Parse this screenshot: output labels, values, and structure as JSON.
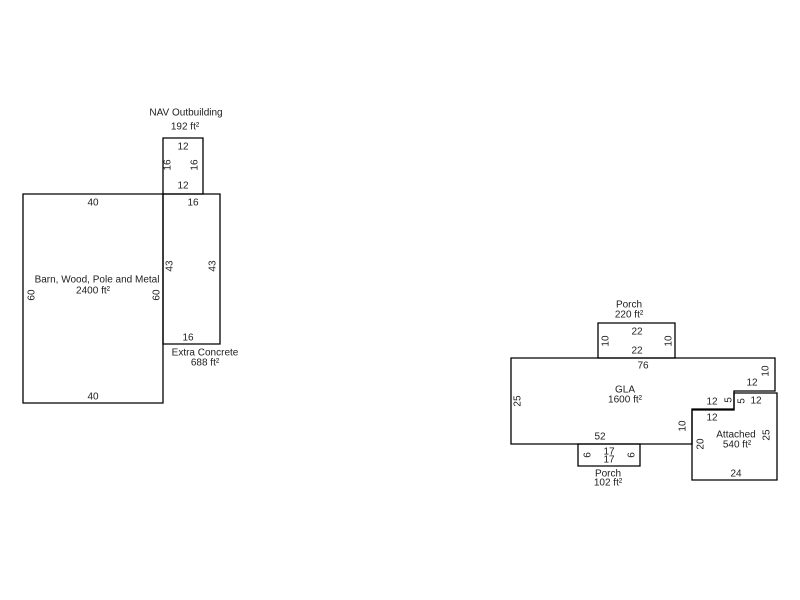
{
  "canvas": {
    "width": 800,
    "height": 600,
    "background": "#ffffff",
    "line_color": "#000000",
    "text_color": "#1d1d1d"
  },
  "sketch": {
    "shapes": [
      {
        "id": "nav-outbuilding",
        "name": "NAV Outbuilding",
        "area_label": "192 ft²",
        "polygon": [
          [
            163,
            138
          ],
          [
            203,
            138
          ],
          [
            203,
            194
          ],
          [
            163,
            194
          ]
        ],
        "labels": [
          {
            "text": "NAV Outbuilding",
            "x": 186,
            "y": 112,
            "kind": "name"
          },
          {
            "text": "192 ft²",
            "x": 185,
            "y": 126,
            "kind": "area"
          },
          {
            "text": "12",
            "x": 183,
            "y": 146
          },
          {
            "text": "16",
            "x": 167,
            "y": 165,
            "rot": -90
          },
          {
            "text": "16",
            "x": 194,
            "y": 165,
            "rot": -90
          },
          {
            "text": "12",
            "x": 183,
            "y": 185
          }
        ]
      },
      {
        "id": "barn",
        "name": "Barn, Wood, Pole and Metal",
        "area_label": "2400 ft²",
        "polygon": [
          [
            23,
            194
          ],
          [
            163,
            194
          ],
          [
            163,
            403
          ],
          [
            23,
            403
          ]
        ],
        "labels": [
          {
            "text": "40",
            "x": 93,
            "y": 202
          },
          {
            "text": "Barn, Wood, Pole and Metal",
            "x": 97,
            "y": 279,
            "kind": "name"
          },
          {
            "text": "2400 ft²",
            "x": 93,
            "y": 290,
            "kind": "area"
          },
          {
            "text": "60",
            "x": 31,
            "y": 295,
            "rot": -90
          },
          {
            "text": "60",
            "x": 156,
            "y": 295,
            "rot": -90
          },
          {
            "text": "40",
            "x": 93,
            "y": 396
          }
        ]
      },
      {
        "id": "extra-concrete",
        "name": "Extra Concrete",
        "area_label": "688 ft²",
        "polygon": [
          [
            163,
            194
          ],
          [
            220,
            194
          ],
          [
            220,
            344
          ],
          [
            163,
            344
          ]
        ],
        "labels": [
          {
            "text": "16",
            "x": 193,
            "y": 202
          },
          {
            "text": "43",
            "x": 169,
            "y": 266,
            "rot": -90
          },
          {
            "text": "43",
            "x": 212,
            "y": 266,
            "rot": -90
          },
          {
            "text": "16",
            "x": 188,
            "y": 337
          },
          {
            "text": "Extra Concrete",
            "x": 205,
            "y": 352,
            "kind": "name"
          },
          {
            "text": "688 ft²",
            "x": 205,
            "y": 362,
            "kind": "area"
          }
        ]
      },
      {
        "id": "porch-top",
        "name": "Porch",
        "area_label": "220 ft²",
        "polygon": [
          [
            598,
            323
          ],
          [
            675,
            323
          ],
          [
            675,
            358
          ],
          [
            598,
            358
          ]
        ],
        "labels": [
          {
            "text": "Porch",
            "x": 629,
            "y": 304,
            "kind": "name"
          },
          {
            "text": "220 ft²",
            "x": 629,
            "y": 314,
            "kind": "area"
          },
          {
            "text": "22",
            "x": 637,
            "y": 331
          },
          {
            "text": "10",
            "x": 605,
            "y": 341,
            "rot": -90
          },
          {
            "text": "10",
            "x": 668,
            "y": 341,
            "rot": -90
          },
          {
            "text": "22",
            "x": 637,
            "y": 350
          }
        ]
      },
      {
        "id": "gla",
        "name": "GLA",
        "area_label": "1600 ft²",
        "polygon": [
          [
            511,
            358
          ],
          [
            775,
            358
          ],
          [
            775,
            391
          ],
          [
            734,
            391
          ],
          [
            734,
            409
          ],
          [
            692,
            409
          ],
          [
            692,
            444
          ],
          [
            511,
            444
          ]
        ],
        "labels": [
          {
            "text": "76",
            "x": 643,
            "y": 365
          },
          {
            "text": "GLA",
            "x": 625,
            "y": 389,
            "kind": "name"
          },
          {
            "text": "1600 ft²",
            "x": 625,
            "y": 399,
            "kind": "area"
          },
          {
            "text": "25",
            "x": 517,
            "y": 401,
            "rot": -90
          },
          {
            "text": "10",
            "x": 765,
            "y": 371,
            "rot": -90
          },
          {
            "text": "12",
            "x": 752,
            "y": 382
          },
          {
            "text": "5",
            "x": 728,
            "y": 400,
            "rot": -90
          },
          {
            "text": "12",
            "x": 712,
            "y": 401
          },
          {
            "text": "10",
            "x": 682,
            "y": 426,
            "rot": -90
          },
          {
            "text": "52",
            "x": 600,
            "y": 436
          }
        ]
      },
      {
        "id": "porch-bottom",
        "name": "Porch",
        "area_label": "102 ft²",
        "polygon": [
          [
            578,
            444
          ],
          [
            640,
            444
          ],
          [
            640,
            466
          ],
          [
            578,
            466
          ]
        ],
        "labels": [
          {
            "text": "17",
            "x": 609,
            "y": 451
          },
          {
            "text": "17",
            "x": 609,
            "y": 459
          },
          {
            "text": "6",
            "x": 587,
            "y": 455,
            "rot": -90
          },
          {
            "text": "6",
            "x": 631,
            "y": 455,
            "rot": -90
          },
          {
            "text": "Porch",
            "x": 608,
            "y": 473,
            "kind": "name"
          },
          {
            "text": "102 ft²",
            "x": 608,
            "y": 482,
            "kind": "area"
          }
        ]
      },
      {
        "id": "attached",
        "name": "Attached",
        "area_label": "540 ft²",
        "polygon": [
          [
            692,
            410
          ],
          [
            734,
            410
          ],
          [
            734,
            393
          ],
          [
            777,
            393
          ],
          [
            777,
            480
          ],
          [
            692,
            480
          ]
        ],
        "labels": [
          {
            "text": "12",
            "x": 712,
            "y": 417
          },
          {
            "text": "5",
            "x": 741,
            "y": 401,
            "rot": -90
          },
          {
            "text": "12",
            "x": 756,
            "y": 400
          },
          {
            "text": "Attached",
            "x": 736,
            "y": 434,
            "kind": "name"
          },
          {
            "text": "540 ft²",
            "x": 737,
            "y": 444,
            "kind": "area"
          },
          {
            "text": "25",
            "x": 766,
            "y": 435,
            "rot": -90
          },
          {
            "text": "20",
            "x": 700,
            "y": 444,
            "rot": -90
          },
          {
            "text": "24",
            "x": 736,
            "y": 473
          }
        ]
      }
    ]
  }
}
